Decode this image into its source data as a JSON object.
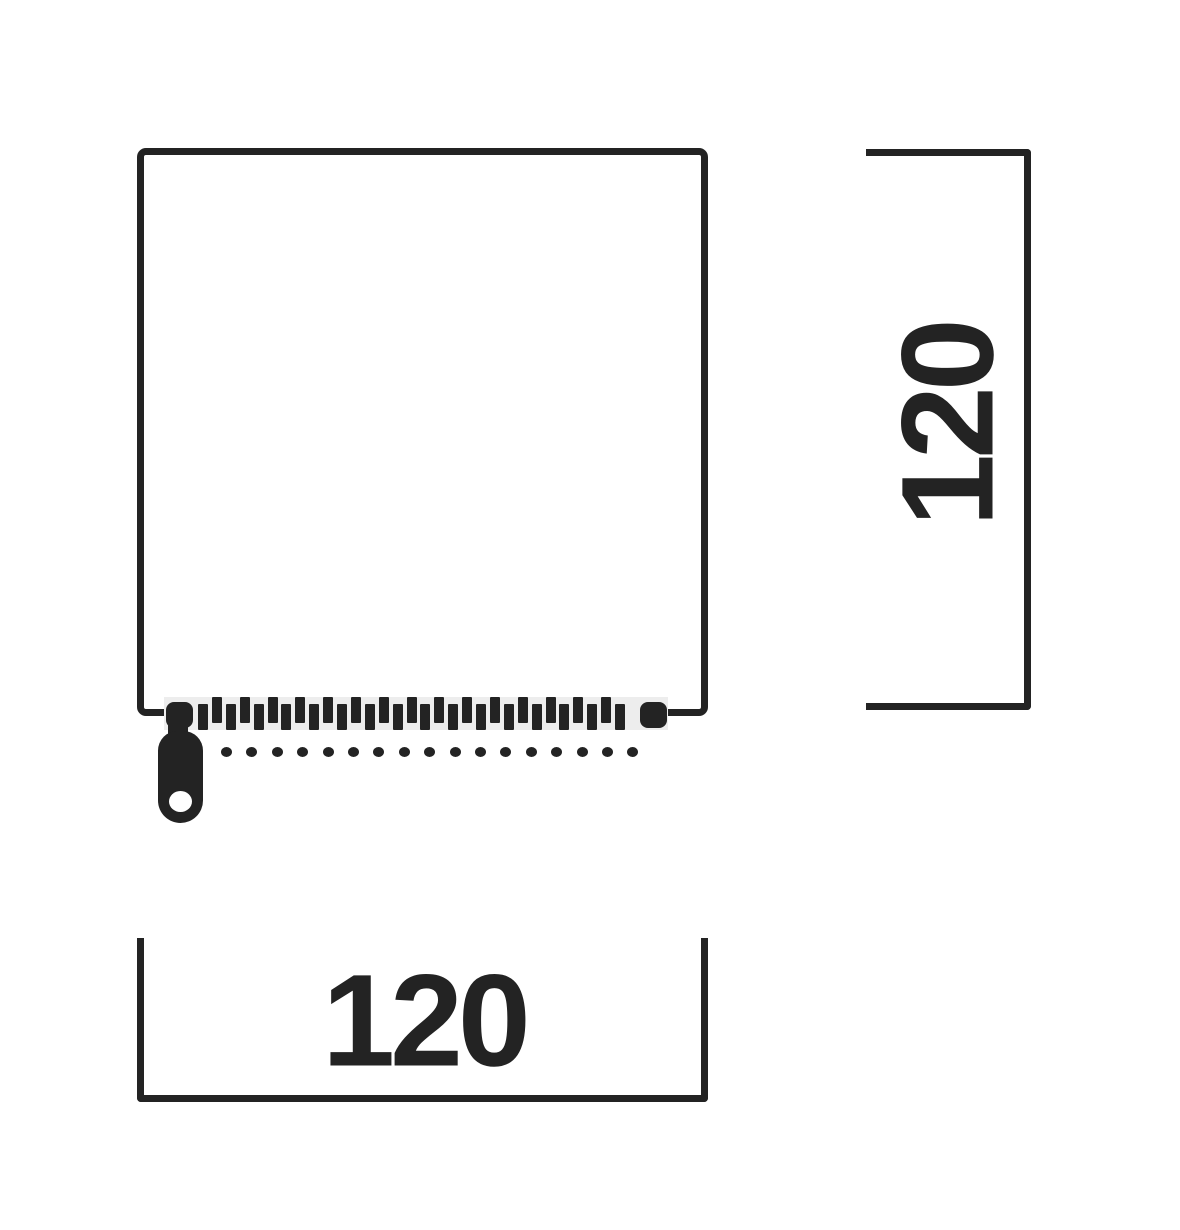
{
  "diagram": {
    "width_label": "120",
    "height_label": "120"
  },
  "zipper": {
    "teeth_count": 31,
    "stitch_dot_count": 17
  },
  "colors": {
    "ink": "#232323",
    "tape": "#ededed",
    "background": "#ffffff"
  }
}
